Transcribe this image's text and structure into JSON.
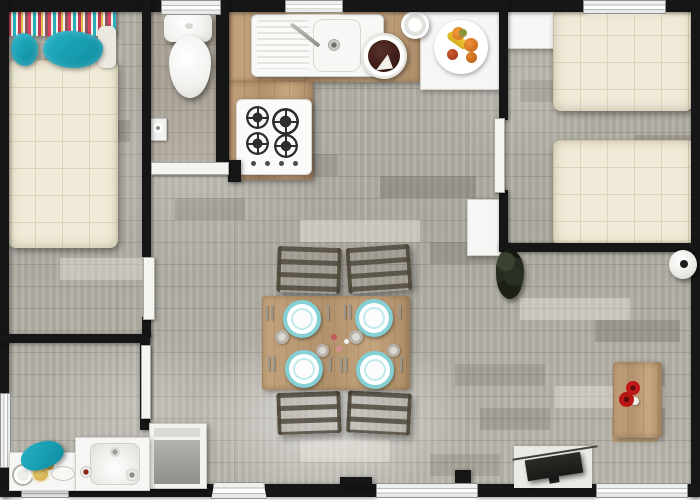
{
  "meta": {
    "title": "Mobile home floor plan — top-down 3D render",
    "description": "Overhead rendered floor plan with two bedrooms, WC, kitchen, dining area, living corner and bathroom on grey wood-plank flooring",
    "canvas": {
      "width": 700,
      "height": 500
    }
  },
  "palette": {
    "wall": "#161616",
    "floor_base": "#b2afa6",
    "counter_wood": "#bfa07c",
    "table_wood": "#bb9c75",
    "quilt_cream": "#f0ebd8",
    "teal_accent": "#17a3b8",
    "plate_rim": "#85d0d5",
    "appliance_white": "#f6f6f4",
    "tv_dark": "#242220",
    "flower_red": "#c01818"
  },
  "rooms": {
    "master_bedroom": "Master bedroom",
    "wc": "WC",
    "kitchen": "Kitchen",
    "twin_bedroom": "Twin bedroom",
    "living_dining": "Living and dining area",
    "bathroom": "Bathroom",
    "hall": "Entrance hall"
  },
  "furniture": {
    "double_bed": "Double bed with cream quilt",
    "striped_headboard": "Striped headboard cushion",
    "teal_pillow": "Teal pillow",
    "toilet": "Toilet",
    "toilet_paper": "Toilet paper holder",
    "kitchen_counter": "Kitchen counter",
    "sink": "Kitchen sink with drainboard",
    "stove": "Gas hob with 4 burners",
    "cake": "Chocolate cake on plate",
    "coffee_cup": "Coffee cup",
    "fruit_bowl": "Fruit bowl",
    "side_table": "White side table",
    "wardrobe": "Wardrobe shelf",
    "single_bed_top": "Single bed",
    "single_bed_bottom": "Single bed",
    "fridge": "Fridge cabinet",
    "dining_table": "Dining table with four place settings",
    "plate": "Teal-rimmed plate",
    "saucer": "Small saucer",
    "chair": "Dining chair",
    "plant": "Dark potted plant",
    "round_stool": "Round stool",
    "coffee_table": "Coffee table with red flowers",
    "flowers": "Red flowers",
    "tv": "Wall-mounted TV",
    "washing_machine": "Washing machine",
    "vanity": "Bathroom washbasin",
    "shelf": "Bathroom shelf with toiletries",
    "towel": "Teal towel"
  },
  "openings": {
    "window": "Window",
    "entrance_door": "Entrance door",
    "interior_door": "Interior door"
  }
}
